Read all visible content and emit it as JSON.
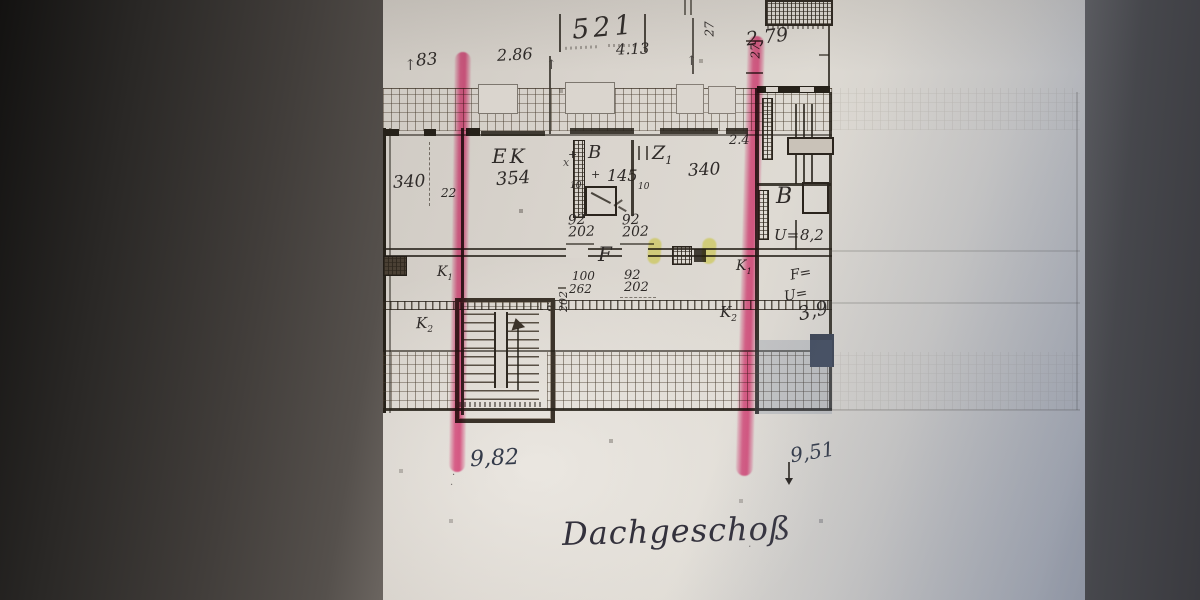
{
  "photo": {
    "dims": {
      "d83": "83",
      "d286": "2.86",
      "d521": "521",
      "d413": "4.13",
      "d279": "2,79",
      "d27a": "27",
      "d27b": "27",
      "d24": "2.4",
      "d22": "22",
      "d10a": "10",
      "d10b": "10",
      "d100": "100",
      "d262": "262"
    },
    "rooms": {
      "ek": "EK",
      "ek_area": "354",
      "b": "B",
      "b_area": "145",
      "z": "Z",
      "z_sub": "1",
      "z_area": "340",
      "left_area": "340",
      "rb": "B"
    },
    "doors": [
      {
        "w": "92",
        "h": "202"
      },
      {
        "w": "92",
        "h": "202"
      },
      {
        "w": "92",
        "h": "202"
      },
      {
        "w": "92",
        "h": "202"
      }
    ],
    "k": {
      "letter": "K",
      "one": "1",
      "two": "2"
    },
    "hall": {
      "f": "F"
    },
    "right": {
      "u1": "U=",
      "v82": "8,2",
      "f": "F=",
      "u2": "U=",
      "v39": "3,9"
    },
    "bottom": {
      "left": "9,82",
      "right": "9,51",
      "title": "Dachgeschoß"
    },
    "icons": {
      "up": "↑",
      "plus": "+",
      "x": "x",
      "dot": "·"
    }
  }
}
